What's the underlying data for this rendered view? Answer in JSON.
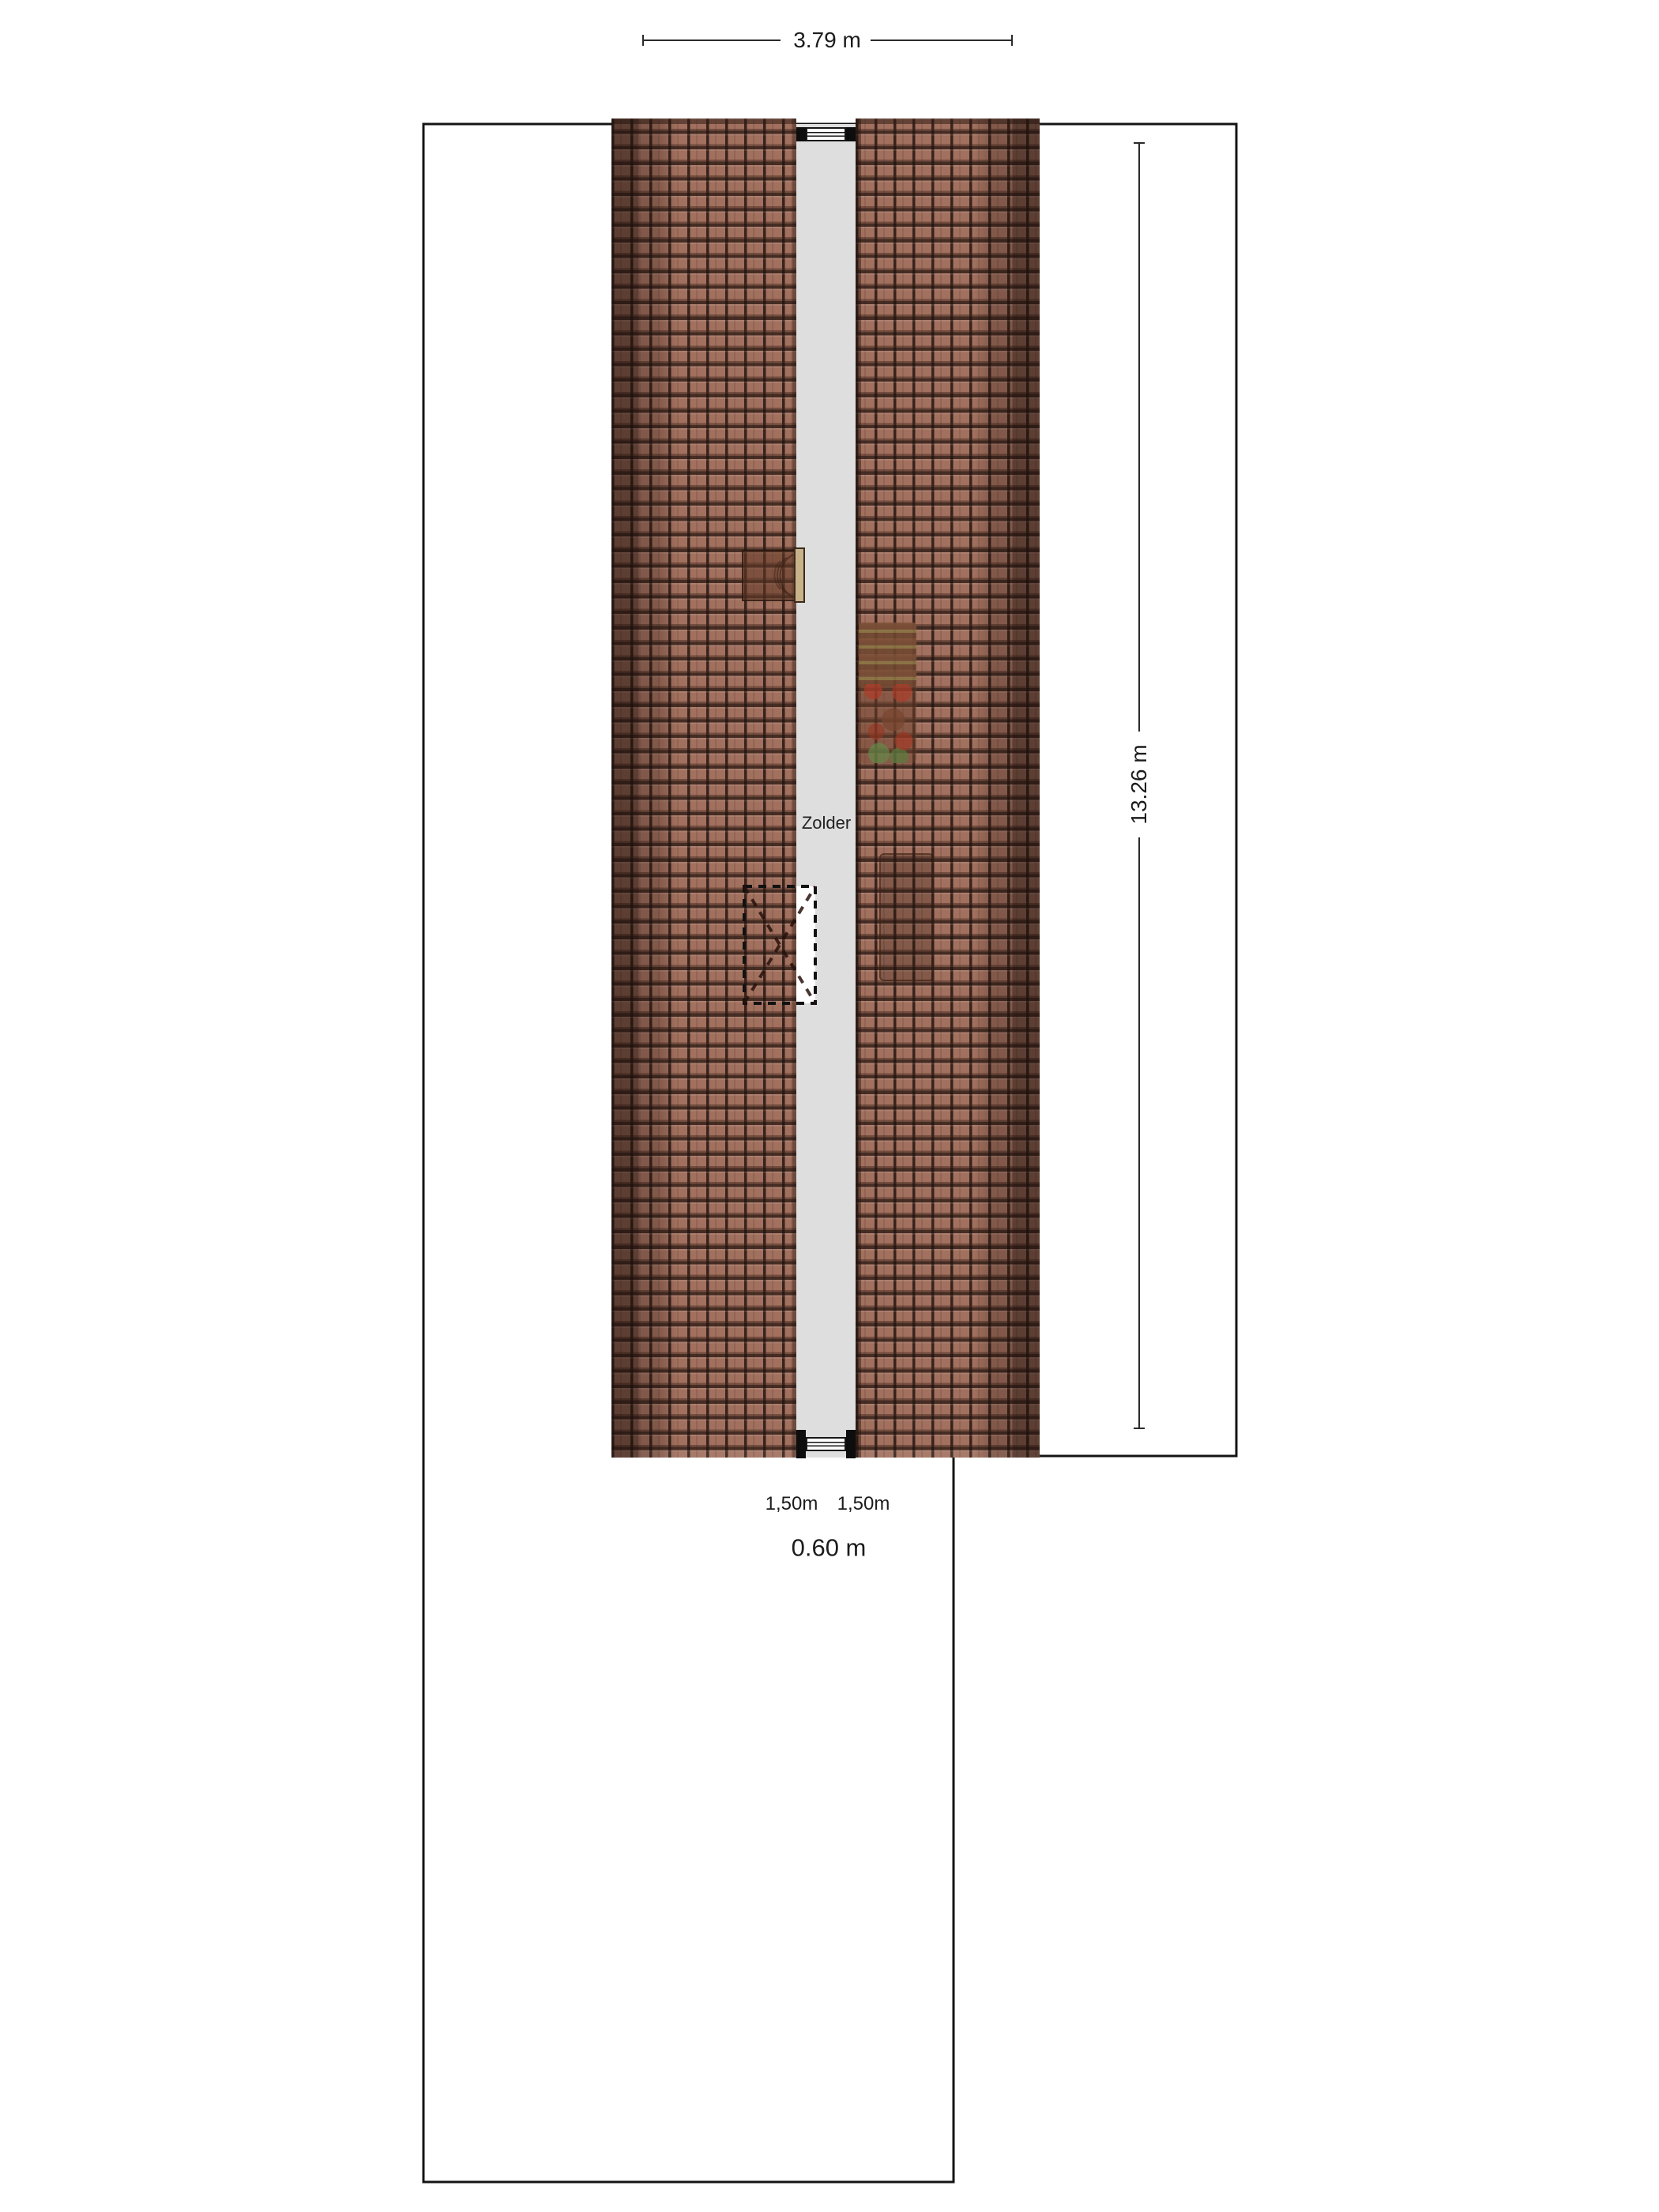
{
  "plan": {
    "room_label": "Zolder",
    "dim_width": "3.79 m",
    "dim_height": "13.26 m",
    "knee_wall_left": "1,50m",
    "knee_wall_right": "1,50m",
    "eave_offset": "0.60 m",
    "colors": {
      "roof_tile": "#a2705e",
      "roof_tile_line": "#2e1b14",
      "roof_edge_shadow": "#402a20",
      "attic_floor_strip": "#dedede",
      "plan_outline": "#141414",
      "dimension_line": "#2a2a2a",
      "window_cap": "#0d0d0d",
      "skylight_bar": "#c8b28a",
      "texture_red": "#a83c28",
      "texture_green": "#5a7840"
    }
  }
}
